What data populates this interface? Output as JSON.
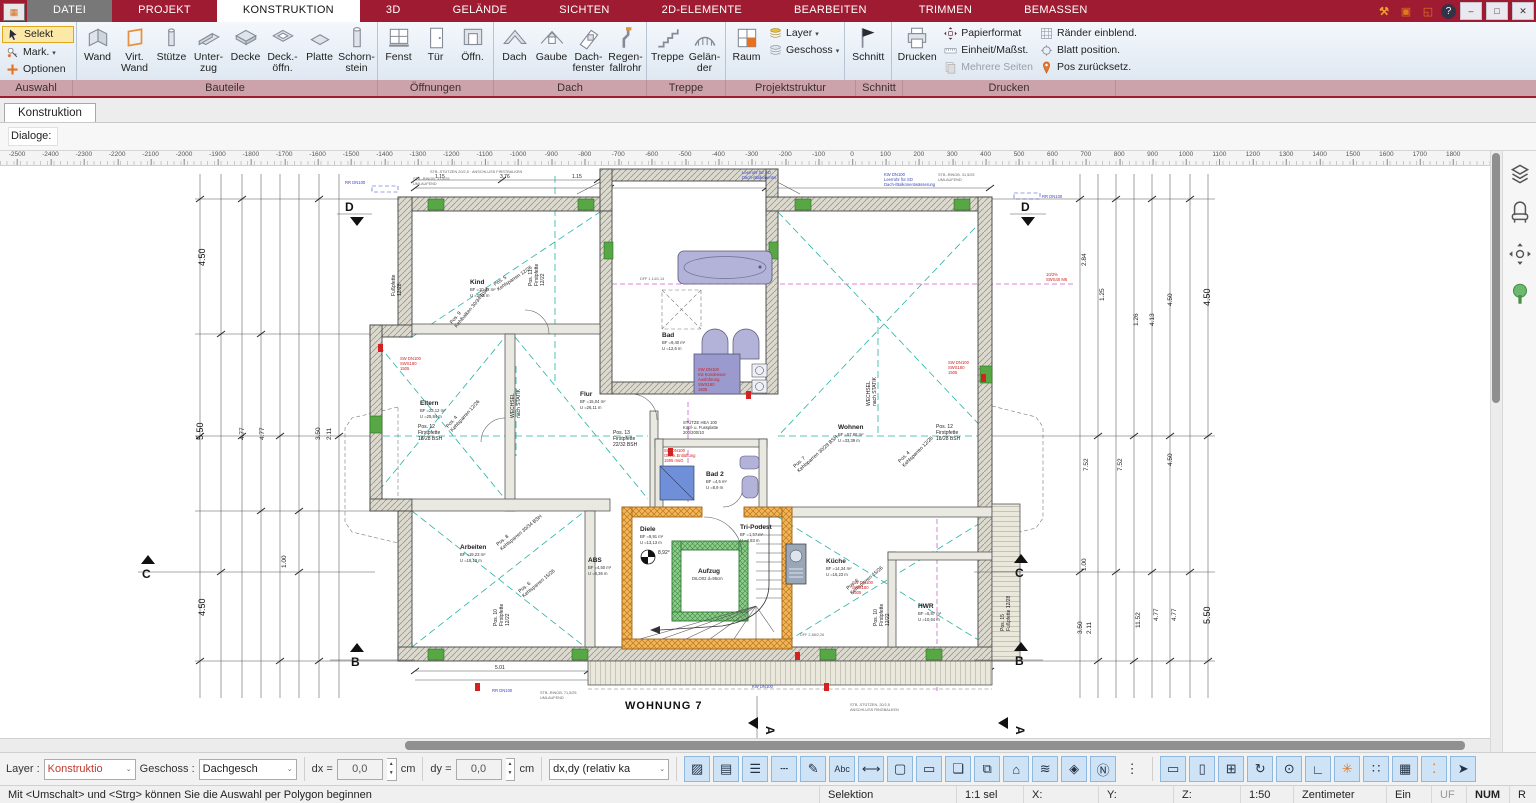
{
  "app_icon": "▦",
  "tabs": [
    "DATEI",
    "PROJEKT",
    "KONSTRUKTION",
    "3D",
    "GELÄNDE",
    "SICHTEN",
    "2D-ELEMENTE",
    "BEARBEITEN",
    "TRIMMEN",
    "BEMASSEN"
  ],
  "tabs_active_index": 2,
  "window": {
    "tools": "⚒",
    "square": "▣",
    "monitor": "◱",
    "help": "?",
    "min": "–",
    "restore": "□",
    "close": "✕"
  },
  "ribbon": {
    "groups": {
      "auswahl": "Auswahl",
      "bauteile": "Bauteile",
      "oeffnungen": "Öffnungen",
      "dach": "Dach",
      "treppe": "Treppe",
      "projekt": "Projektstruktur",
      "schnitt": "Schnitt",
      "drucken": "Drucken"
    },
    "selekt": "Selekt",
    "mark": "Mark.",
    "optionen": "Optionen",
    "wand": "Wand",
    "vwand": "Virt.\nWand",
    "stuetze": "Stütze",
    "unterzug": "Unter-\nzug",
    "decke": "Decke",
    "deckoeffn": "Deck.-\nöffn.",
    "platte": "Platte",
    "schornstein": "Schorn-\nstein",
    "fenst": "Fenst",
    "tuer": "Tür",
    "oeffn": "Öffn.",
    "dach": "Dach",
    "gaube": "Gaube",
    "dachfenster": "Dach-\nfenster",
    "regenfallrohr": "Regen-\nfallrohr",
    "treppe": "Treppe",
    "gelaender": "Gelän-\nder",
    "raum": "Raum",
    "layer": "Layer",
    "geschoss": "Geschoss",
    "schnitt": "Schnitt",
    "drucken": "Drucken",
    "papierformat": "Papierformat",
    "einheit": "Einheit/Maßst.",
    "mehrere": "Mehrere Seiten",
    "raender": "Ränder einblend.",
    "blatt": "Blatt position.",
    "posz": "Pos zurücksetz."
  },
  "doctab": "Konstruktion",
  "dialoge_label": "Dialoge:",
  "ruler": {
    "start": -2500,
    "end": 1900,
    "step": 100,
    "x0": 17,
    "px": 33.4
  },
  "bottom_toolbar": {
    "layer_label": "Layer :",
    "layer_value": "Konstruktio",
    "geschoss_label": "Geschoss :",
    "geschoss_value": "Dachgesch",
    "dx_label": "dx =",
    "dx_value": "0,0",
    "dx_unit": "cm",
    "dy_label": "dy =",
    "dy_value": "0,0",
    "dy_unit": "cm",
    "mode_value": "dx,dy (relativ ka",
    "icons1": [
      {
        "n": "hatch-icon",
        "g": "▨"
      },
      {
        "n": "fill-color-icon",
        "g": "▤"
      },
      {
        "n": "line-weight-icon",
        "g": "☰"
      },
      {
        "n": "line-style-icon",
        "g": "┄"
      },
      {
        "n": "pen-icon",
        "g": "✎"
      },
      {
        "n": "text-abc-icon",
        "g": "Abc"
      },
      {
        "n": "dimension-icon",
        "g": "⟷"
      },
      {
        "n": "marquee-icon",
        "g": "▢"
      },
      {
        "n": "rectangle-icon",
        "g": "▭"
      },
      {
        "n": "copy-layers-icon",
        "g": "❏"
      },
      {
        "n": "move-copy-icon",
        "g": "⧉"
      },
      {
        "n": "roof-tool-icon",
        "g": "⌂"
      },
      {
        "n": "layer-stack-icon",
        "g": "≋"
      },
      {
        "n": "tile-icon",
        "g": "◈"
      },
      {
        "n": "north-icon",
        "g": "Ⓝ"
      },
      {
        "n": "more-dots-icon",
        "g": "⋮",
        "plain": true
      }
    ],
    "icons2": [
      {
        "n": "ruler-icon",
        "g": "▭"
      },
      {
        "n": "page-icon",
        "g": "▯"
      },
      {
        "n": "window-grid-icon",
        "g": "⊞"
      },
      {
        "n": "rotate-view-icon",
        "g": "↻"
      },
      {
        "n": "ref-point-icon",
        "g": "⊙"
      },
      {
        "n": "corner-icon",
        "g": "∟"
      },
      {
        "n": "snap-point-icon",
        "g": "✳",
        "orange": true
      },
      {
        "n": "grid-snap-icon",
        "g": "∷"
      },
      {
        "n": "grid-icon",
        "g": "▦"
      },
      {
        "n": "snap-settings-icon",
        "g": "⁚",
        "orange": true
      },
      {
        "n": "deselect-cursor-icon",
        "g": "➤"
      }
    ]
  },
  "status": {
    "message": "Mit <Umschalt> und <Strg> können Sie die Auswahl per Polygon beginnen",
    "selektion": "Selektion",
    "scale_sel": "1:1 sel",
    "x": "X:",
    "y": "Y:",
    "z": "Z:",
    "scale": "1:50",
    "unit": "Zentimeter",
    "ein": "Ein",
    "uf": "UF",
    "num": "NUM",
    "r": "R"
  },
  "plan": {
    "title": "WOHNUNG 7",
    "sections": {
      "d": "D",
      "c": "C",
      "b": "B",
      "a": "A"
    },
    "north_angle": "8,92°",
    "rooms": {
      "kind": {
        "n": "Kind",
        "a": "BF =10,42 m²",
        "u": "U =20,6 m"
      },
      "eltern": {
        "n": "Eltern",
        "a": "BF =23,12 m²",
        "u": "U =25,84 m"
      },
      "flur": {
        "n": "Flur",
        "a": "BF =15,04 m²",
        "u": "U =26,11 m"
      },
      "bad": {
        "n": "Bad",
        "a": "BF =9,40 m²",
        "u": "U =12,6 m"
      },
      "bad2": {
        "n": "Bad 2",
        "a": "BF =4,5 m²",
        "u": "U =8,9 m"
      },
      "wohnen": {
        "n": "Wohnen",
        "a": "BF =57,86 m²",
        "u": "U =33,39 m"
      },
      "arbeiten": {
        "n": "Arbeiten",
        "a": "BF =19,23 m²",
        "u": "U =18,13 m"
      },
      "abs": {
        "n": "ABS",
        "a": "BF =4,50 m²",
        "u": "U =8,36 m"
      },
      "diele": {
        "n": "Diele",
        "a": "BF =9,91 m²",
        "u": "U =13,13 m"
      },
      "aufzug": {
        "n": "Aufzug",
        "a": "DILO02 d=95cm",
        "u": ""
      },
      "tripodest": {
        "n": "Tri-Podest",
        "a": "BF =1,57 m²",
        "u": "U =4,83 m"
      },
      "kueche": {
        "n": "Küche",
        "a": "BF =14,34 m²",
        "u": "U =16,23 m"
      },
      "hwr": {
        "n": "HWR",
        "a": "BF =5,87 m²",
        "u": "U =10,64 m"
      }
    },
    "pos": {
      "p11": [
        "Pos. 11",
        "Firstpfette",
        "12/22"
      ],
      "p12": [
        "Pos. 12",
        "Firstpfette",
        "18/28 BSH"
      ],
      "p13": [
        "Pos. 13",
        "Firstpfette",
        "22/32 BSH"
      ],
      "p10": [
        "Pos. 10",
        "Firstpfette",
        "12/22"
      ],
      "p15": [
        "Pos. 15",
        "Fußpfette 12/28"
      ],
      "p16": [
        "Fußpfette",
        "12/28"
      ],
      "p5": [
        "Pos. 5",
        "Kehlsparren 12/26"
      ],
      "p9": [
        "Pos. 9",
        "Kehlbalken 30/34 BSH"
      ],
      "p4": [
        "Pos. 4",
        "Kehlsparren 12/26"
      ],
      "p7": [
        "Pos. 7",
        "Kehlsparren 30/28 BSH"
      ],
      "p8": [
        "Pos. 8",
        "Kehlsparren 30/34 BSH"
      ],
      "p6": [
        "Pos. 6",
        "Kehlsparren 15/26"
      ],
      "wechsel": [
        "WECHSEL",
        "nach STATIK"
      ],
      "stuetze": [
        "STÜTZE HEA 100",
        "Kopf- u. Fussplatte",
        "200/200/10"
      ]
    },
    "red": {
      "sw": [
        "SW DN100",
        "SWS180",
        "1505"
      ],
      "kond": [
        "SW DN100",
        "mit Kondensat-",
        "Ausführung",
        "SWS180",
        "1505"
      ],
      "ob": [
        "SW DN100",
        "Oberk.Entlüftung",
        "1595 müG"
      ],
      "m6": [
        "10/2%",
        "SWS40 M6"
      ]
    },
    "blue": {
      "rr": "RR DN100",
      "kw": "KW DN100",
      "leer": [
        "Leerrohr für SD",
        "Dach-/Balkonentw."
      ],
      "kw3": [
        "KW DN100",
        "Leerrohr für SD",
        "Dach-/Balkonentwässerung"
      ]
    },
    "gray": {
      "ringb": [
        "STB.-RINGB. 31,5/25",
        "UMLAUFEND"
      ],
      "ringb2": [
        "STB.-RINGB. 71,5/25",
        "UMLAUFEND"
      ],
      "stz": [
        "STB.-STÜTZEN, 20/2,5",
        "ANSCHLUSS RINGBALKEN"
      ],
      "first": "STB.-STÜTZEN 20/2,5 · ANSCHLUSS FIRSTBALKEN",
      "dff1": "DFF 2,88/2,26",
      "dff2": "DFF 1,14/1,14"
    },
    "dims": {
      "left": [
        "4.50",
        "5.50",
        "4.50",
        "4.77",
        "4.77",
        "1.00",
        "3.50",
        "2.11"
      ],
      "right": [
        "2.84",
        "1.25",
        "1.26",
        "4.13",
        "4.50",
        "4.50",
        "7.52",
        "7.52",
        "1.00",
        "11.52",
        "4.77",
        "4.77",
        "5.50",
        "3.50",
        "2.11",
        "4.50"
      ],
      "top": [
        "1.15",
        "3.76",
        "1.15"
      ],
      "bottom": [
        "5.01",
        "1.50",
        "4.88"
      ]
    }
  },
  "panel_icons": [
    "layers-panes-icon",
    "furniture-icon",
    "pan-view-icon",
    "vegetation-icon"
  ]
}
